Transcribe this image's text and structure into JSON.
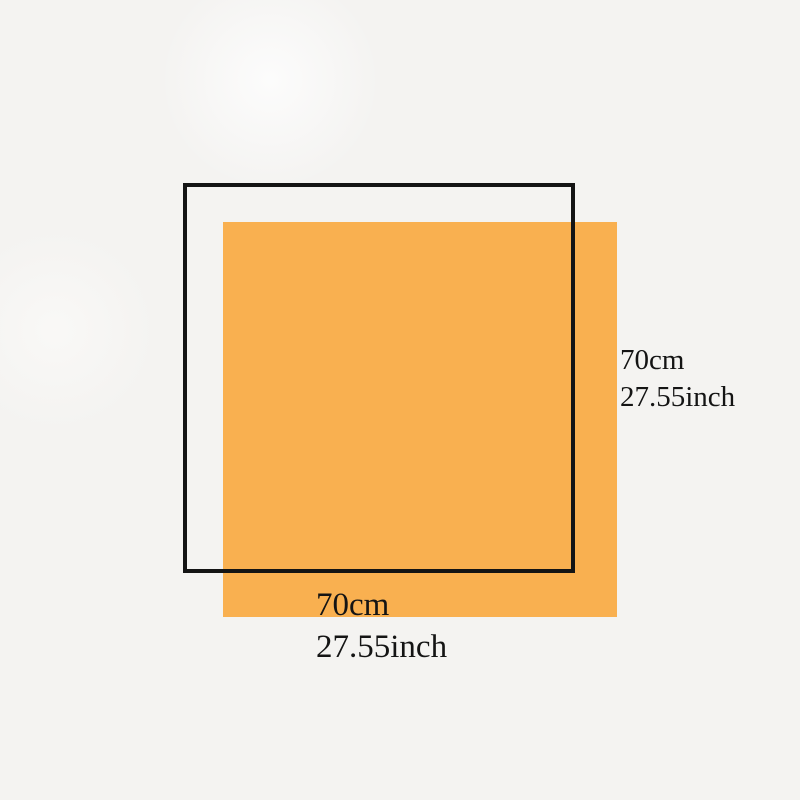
{
  "diagram": {
    "description": "product-dimension-diagram",
    "labels": {
      "height": {
        "cm": "70cm",
        "inch": "27.55inch"
      },
      "width": {
        "cm": "70cm",
        "inch": "27.55inch"
      }
    }
  },
  "colors": {
    "product_fill": "#f9b050",
    "outline": "#141414",
    "background": "#f4f3f1",
    "text": "#141414"
  }
}
